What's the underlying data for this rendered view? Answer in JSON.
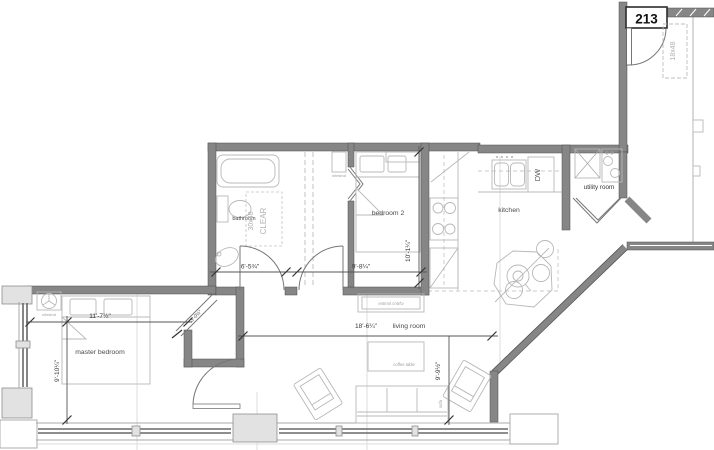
{
  "unit": {
    "number": "213"
  },
  "rooms": {
    "master_bedroom": "master bedroom",
    "bathroom": "bathroom",
    "bedroom_2": "bedroom 2",
    "kitchen": "kitchen",
    "living_room": "living room",
    "utility_room": "utility room"
  },
  "dimensions": {
    "master_bedroom_width": "11'-7½\"",
    "master_bedroom_depth": "9'-10¼\"",
    "bathroom_width": "6'-5¾\"",
    "bedroom_2_width": "9'-8¼\"",
    "bedroom_2_depth": "10'-1¼\"",
    "living_room_width": "18'-6¼\"",
    "living_room_depth": "9'-9½\"",
    "closet_door_width": "3'-0½\""
  },
  "fixtures": {
    "dishwasher": "DW",
    "clear_floor_size": "30x48",
    "clear_floor_note": "CLEAR",
    "entry_storage": "18x48",
    "entertainment_center": "entmnt cntr/tv",
    "coffee_table": "coffee table",
    "sofa": "sofa",
    "nightstand_master": "nitestnd",
    "nightstand_bedroom_2": "nitestnd"
  },
  "colors": {
    "wall": "#868686",
    "wall_edge": "#4d4d4d",
    "furniture_line": "#b8b8b8",
    "dimension_text": "#3a3a3a",
    "label_light": "#9e9e9e",
    "background": "#ffffff"
  }
}
